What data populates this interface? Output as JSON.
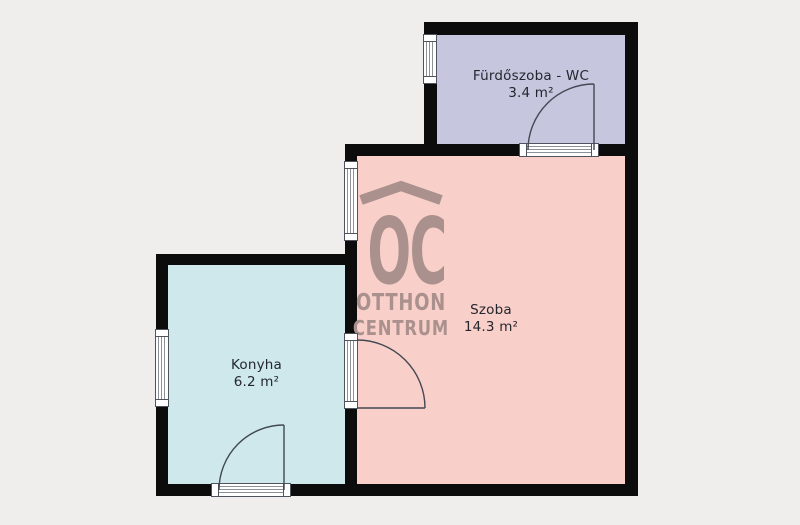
{
  "plan": {
    "background_color": "#f0eeec",
    "wall_color": "#0c0c0d",
    "rooms": [
      {
        "id": "bathroom",
        "name": "Fürdőszoba - WC",
        "area": "3.4 m²",
        "color": "#c6c6de"
      },
      {
        "id": "room",
        "name": "Szoba",
        "area": "14.3 m²",
        "color": "#f9cfc9"
      },
      {
        "id": "kitchen",
        "name": "Konyha",
        "area": "6.2 m²",
        "color": "#cee8ec"
      }
    ]
  },
  "watermark": {
    "symbol": "OC",
    "line1": "OTTHON",
    "line2": "CENTRUM",
    "color": "#aa918e"
  }
}
